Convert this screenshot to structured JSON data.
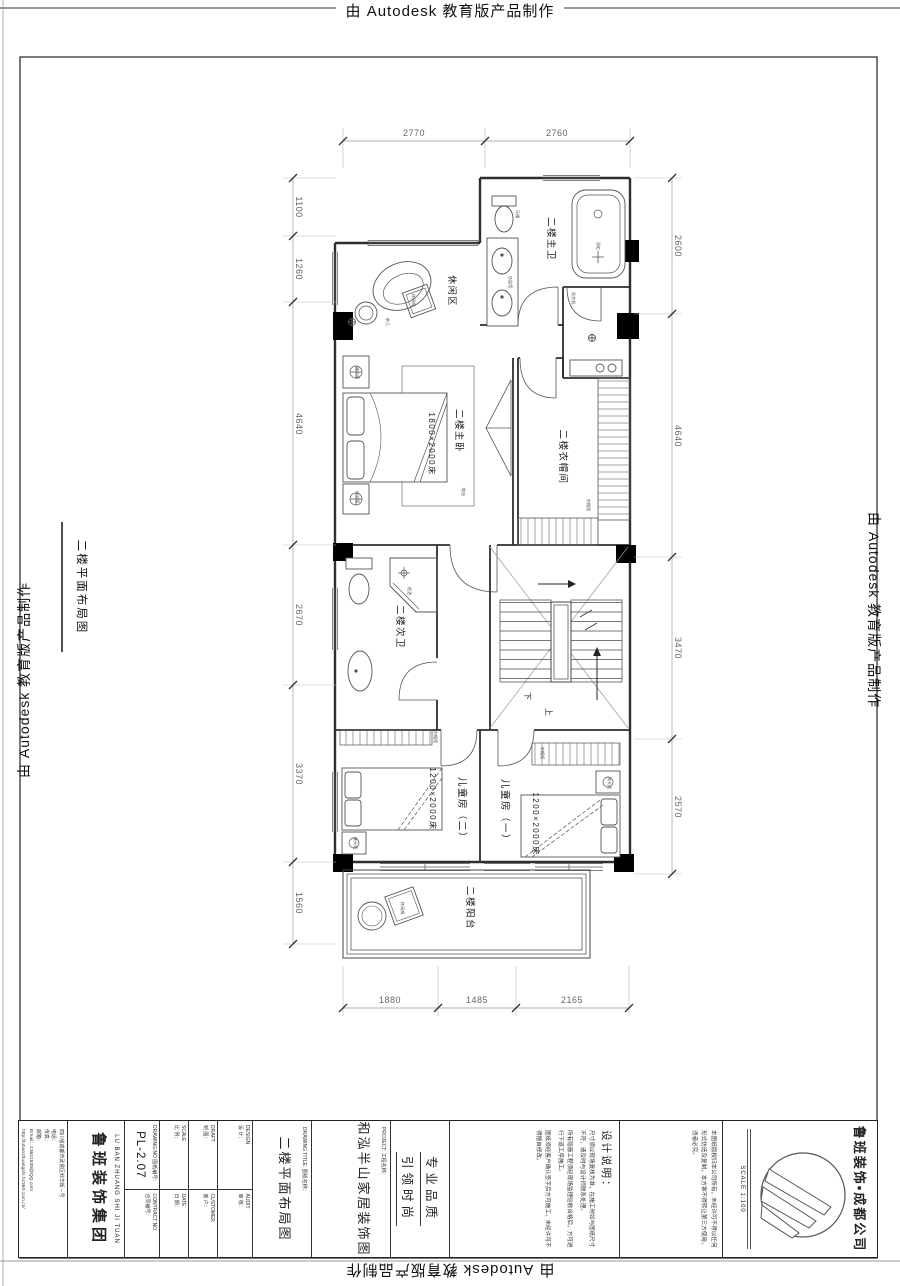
{
  "autodesk_banner": "由 Autodesk 教育版产品制作",
  "plan": {
    "sheet_label": "二楼平面布局图",
    "rooms": {
      "master_bath": "二楼主卫",
      "leisure": "休闲区",
      "master_bedroom": "二楼主卧",
      "cloakroom": "二楼衣帽间",
      "second_bath": "二楼次卫",
      "kids_room_2": "儿童房（二）",
      "kids_room_1": "儿童房（一）",
      "balcony": "二楼阳台"
    },
    "furniture": {
      "master_bed": "1800×2000床",
      "kid2_bed": "1200×2000床",
      "kid1_bed": "1200×2000床"
    },
    "stairs": {
      "down": "下",
      "up": "上"
    },
    "micro": [
      "床头柜",
      "床头柜",
      "台盆柜",
      "马桶",
      "浴缸",
      "衣帽柜",
      "衣帽柜",
      "衣帽柜",
      "洗衣机",
      "花洒",
      "茶几",
      "休闲椅",
      "地台",
      "床头柜",
      "床头柜",
      "休闲椅"
    ],
    "dims": {
      "top": [
        "2770",
        "2760"
      ],
      "bottom": [
        "1880",
        "1485",
        "2165"
      ],
      "left": [
        "1100",
        "1260",
        "4640",
        "2670",
        "3370",
        "1560"
      ],
      "right": [
        "2600",
        "4640",
        "3470",
        "2570"
      ]
    }
  },
  "titleblock": {
    "branch": "鲁班装饰•成都公司",
    "scale_value": "SCALE 1:100",
    "copyright": "本图纸版权归本公司所有，未经许可不得以任何形式仿造及复制，本方案不得转让第三方使用，违者必究。",
    "notes_title": "设计说明：",
    "notes": [
      "尺寸须以现场复核为准，在施工时如与图纸尺寸不符，请及时与设计师联系处理。",
      "所有隐蔽工程须经现场监理验收合格后，方可进行下道工序施工。",
      "图纸须经客户确认签字后方可施工，未经许可不得擅自修改。"
    ],
    "slogan1": "专业品质",
    "slogan2": "引领时尚",
    "project_en": "PROJECT:",
    "project_cn": "工程名称：",
    "project_name": "和泓半山家居装饰图",
    "title_en": "DRAWING TITLE:",
    "title_cn": "图纸名称：",
    "drawing_title": "二楼平面布局图",
    "design_en": "DESIGN",
    "design_cn": "设 计：",
    "audit_en": "AUDIT",
    "audit_cn": "审 核：",
    "draft_en": "DRAFT",
    "draft_cn": "制 图：",
    "customer_en": "CUSTOMER",
    "customer_cn": "客 户：",
    "scale_en": "SCALE",
    "scale_cn": "比 例：",
    "date_en": "DATE",
    "date_cn": "日 期：",
    "drawing_no_en": "DRAWING NO",
    "drawing_no_cn": "图纸编号：",
    "drawing_no": "PL-2.07",
    "contract_en": "CONTRACT NO",
    "contract_cn": "合同编号：",
    "company_en": "LU BAN ZHUANG SHI JI TUAN",
    "company_cn": "鲁班装饰集团",
    "address": "四川省成都市武侯区科华街－号",
    "tel": "电话：",
    "fax": "传真：",
    "mail_label": "邮箱：",
    "email": "Email：13621839@QQ.com",
    "website": "http://lubanzhuangshi.hc360.com.cn/"
  }
}
